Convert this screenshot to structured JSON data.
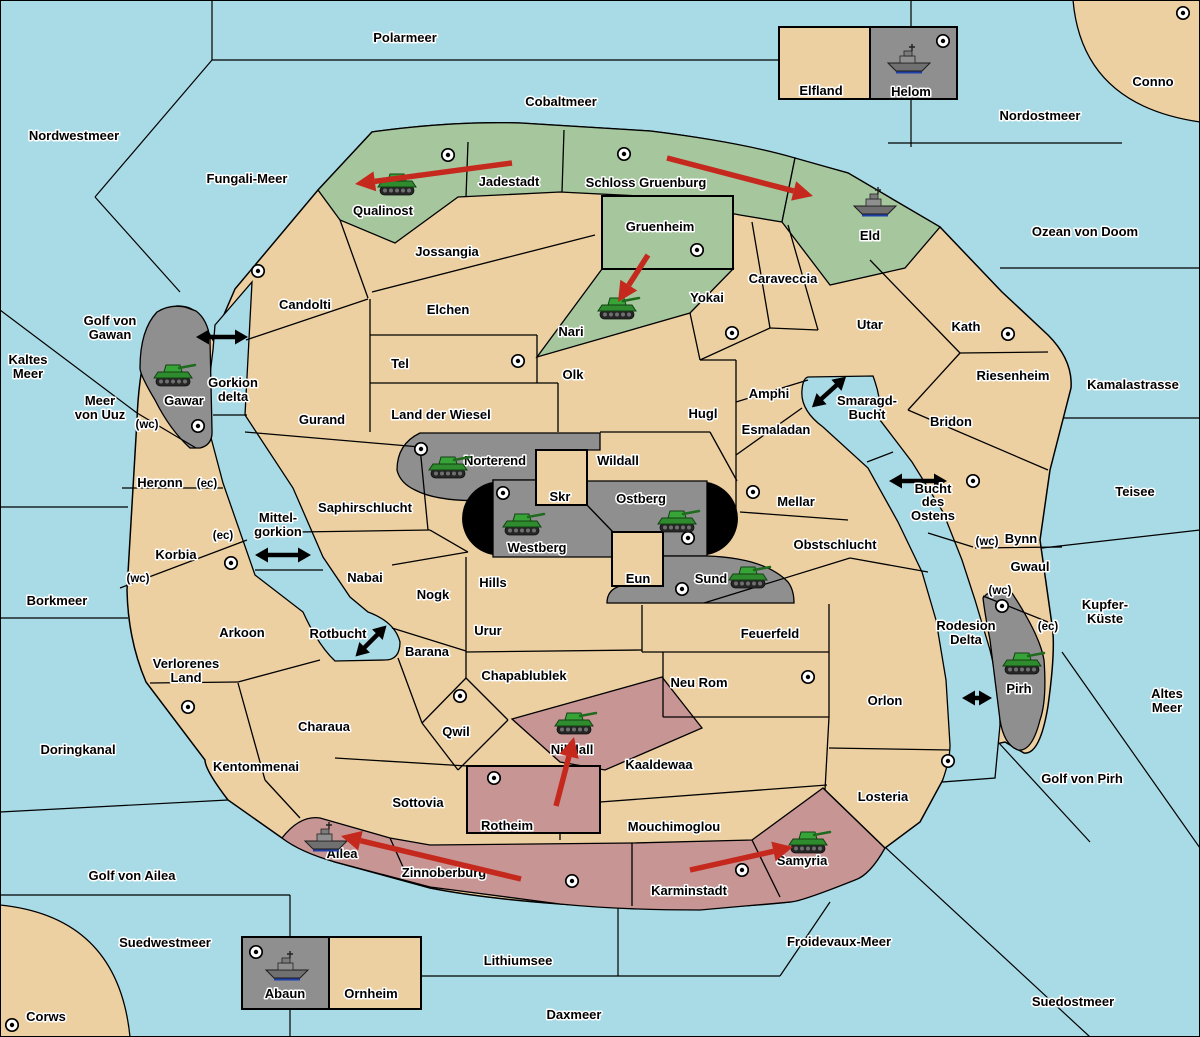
{
  "map_title": "Diplomacy variant game map",
  "colors": {
    "sea": "#a9dbe7",
    "land": "#edd0a2",
    "green_power": "#a6c79e",
    "gray_power": "#8f8f8f",
    "red_power": "#c79694",
    "move_arrow": "#c5291d",
    "border": "#000000",
    "impassable": "#000000"
  },
  "seas": [
    {
      "name": "Polarmeer",
      "x": 405,
      "y": 38
    },
    {
      "name": "Cobaltmeer",
      "x": 561,
      "y": 102
    },
    {
      "name": "Nordwestmeer",
      "x": 74,
      "y": 136
    },
    {
      "name": "Fungali-Meer",
      "x": 247,
      "y": 179
    },
    {
      "name": "Nordostmeer",
      "x": 1040,
      "y": 116
    },
    {
      "name": "Ozean von Doom",
      "x": 1085,
      "y": 232
    },
    {
      "name": "Kaltes Meer",
      "lines": [
        "Kaltes",
        "Meer"
      ],
      "x": 28,
      "y": 367
    },
    {
      "name": "Golf von Gawan",
      "lines": [
        "Golf von",
        "Gawan"
      ],
      "x": 110,
      "y": 328
    },
    {
      "name": "Meer von Uuz",
      "lines": [
        "Meer",
        "von Uuz"
      ],
      "x": 100,
      "y": 408
    },
    {
      "name": "Kamalastrasse",
      "x": 1133,
      "y": 385
    },
    {
      "name": "Teisee",
      "x": 1135,
      "y": 492
    },
    {
      "name": "Borkmeer",
      "x": 57,
      "y": 601
    },
    {
      "name": "Kupfer-Küste",
      "lines": [
        "Kupfer-",
        "Küste"
      ],
      "x": 1105,
      "y": 612
    },
    {
      "name": "Altes Meer",
      "lines": [
        "Altes",
        "Meer"
      ],
      "x": 1167,
      "y": 701
    },
    {
      "name": "Doringkanal",
      "x": 78,
      "y": 750
    },
    {
      "name": "Golf von Pirh",
      "x": 1082,
      "y": 779
    },
    {
      "name": "Golf von Ailea",
      "x": 132,
      "y": 876
    },
    {
      "name": "Suedwestmeer",
      "x": 165,
      "y": 943
    },
    {
      "name": "Lithiumsee",
      "x": 518,
      "y": 961
    },
    {
      "name": "Froidevaux-Meer",
      "x": 839,
      "y": 942
    },
    {
      "name": "Daxmeer",
      "x": 574,
      "y": 1015
    },
    {
      "name": "Suedostmeer",
      "x": 1073,
      "y": 1002
    },
    {
      "name": "Gorkion delta",
      "lines": [
        "Gorkion",
        "delta"
      ],
      "x": 233,
      "y": 390
    },
    {
      "name": "Mittel-gorkion",
      "lines": [
        "Mittel-",
        "gorkion"
      ],
      "x": 278,
      "y": 525
    },
    {
      "name": "Rotbucht",
      "x": 338,
      "y": 634
    },
    {
      "name": "Smaragd-Bucht",
      "lines": [
        "Smaragd-",
        "Bucht"
      ],
      "x": 867,
      "y": 408
    },
    {
      "name": "Bucht des Ostens",
      "lines": [
        "Bucht",
        "des",
        "Ostens"
      ],
      "x": 933,
      "y": 502
    },
    {
      "name": "Rodesion Delta",
      "lines": [
        "Rodesion",
        "Delta"
      ],
      "x": 966,
      "y": 633
    }
  ],
  "territories": [
    {
      "name": "Conno",
      "color": "tan",
      "x": 1153,
      "y": 82,
      "sc": [
        1183,
        13
      ]
    },
    {
      "name": "Corws",
      "color": "tan",
      "x": 46,
      "y": 1017,
      "sc": [
        12,
        1025
      ]
    },
    {
      "name": "Elfland",
      "color": "tan",
      "x": 821,
      "y": 91
    },
    {
      "name": "Ornheim",
      "color": "tan",
      "x": 371,
      "y": 994
    },
    {
      "name": "Candolti",
      "color": "tan",
      "x": 305,
      "y": 305,
      "sc": [
        258,
        271
      ]
    },
    {
      "name": "Jossangia",
      "color": "tan",
      "x": 447,
      "y": 252
    },
    {
      "name": "Elchen",
      "color": "tan",
      "x": 448,
      "y": 310
    },
    {
      "name": "Tel",
      "color": "tan",
      "x": 400,
      "y": 364,
      "sc": [
        518,
        361
      ]
    },
    {
      "name": "Olk",
      "color": "tan",
      "x": 573,
      "y": 375
    },
    {
      "name": "Gurand",
      "color": "tan",
      "x": 322,
      "y": 420
    },
    {
      "name": "Land der Wiesel",
      "color": "tan",
      "x": 441,
      "y": 415
    },
    {
      "name": "Hugl",
      "color": "tan",
      "x": 703,
      "y": 414
    },
    {
      "name": "Amphi",
      "color": "tan",
      "x": 769,
      "y": 394
    },
    {
      "name": "Esmaladan",
      "color": "tan",
      "x": 776,
      "y": 430
    },
    {
      "name": "Yokai",
      "color": "tan",
      "x": 707,
      "y": 298,
      "sc": [
        732,
        333
      ]
    },
    {
      "name": "Caraveccia",
      "color": "tan",
      "x": 783,
      "y": 279
    },
    {
      "name": "Utar",
      "color": "tan",
      "x": 870,
      "y": 325
    },
    {
      "name": "Kath",
      "color": "tan",
      "x": 966,
      "y": 327,
      "sc": [
        1008,
        334
      ]
    },
    {
      "name": "Riesenheim",
      "color": "tan",
      "x": 1013,
      "y": 376
    },
    {
      "name": "Bridon",
      "color": "tan",
      "x": 951,
      "y": 422
    },
    {
      "name": "Wildall",
      "color": "tan",
      "x": 618,
      "y": 461
    },
    {
      "name": "Skr",
      "color": "tan",
      "x": 560,
      "y": 497
    },
    {
      "name": "Eun",
      "color": "tan",
      "x": 638,
      "y": 579
    },
    {
      "name": "Mellar",
      "color": "tan",
      "x": 796,
      "y": 502,
      "sc": [
        753,
        492
      ]
    },
    {
      "name": "Obstschlucht",
      "color": "tan",
      "x": 835,
      "y": 545
    },
    {
      "name": "Saphirschlucht",
      "color": "tan",
      "x": 365,
      "y": 508
    },
    {
      "name": "Nabai",
      "color": "tan",
      "x": 365,
      "y": 578
    },
    {
      "name": "Nogk",
      "color": "tan",
      "x": 433,
      "y": 595
    },
    {
      "name": "Hills",
      "color": "tan",
      "x": 493,
      "y": 583
    },
    {
      "name": "Urur",
      "color": "tan",
      "x": 488,
      "y": 631
    },
    {
      "name": "Barana",
      "color": "tan",
      "x": 427,
      "y": 652
    },
    {
      "name": "Chapablublek",
      "color": "tan",
      "x": 524,
      "y": 676
    },
    {
      "name": "Qwil",
      "color": "tan",
      "x": 456,
      "y": 732,
      "sc": [
        460,
        696
      ]
    },
    {
      "name": "Charaua",
      "color": "tan",
      "x": 324,
      "y": 727
    },
    {
      "name": "Arkoon",
      "color": "tan",
      "x": 242,
      "y": 633
    },
    {
      "name": "Verlorenes Land",
      "color": "tan",
      "lines": [
        "Verlorenes",
        "Land"
      ],
      "x": 186,
      "y": 671
    },
    {
      "name": "Kentommenai",
      "color": "tan",
      "x": 256,
      "y": 767,
      "sc": [
        188,
        707
      ]
    },
    {
      "name": "Sottovia",
      "color": "tan",
      "x": 418,
      "y": 803
    },
    {
      "name": "Feuerfeld",
      "color": "tan",
      "x": 770,
      "y": 634
    },
    {
      "name": "Neu Rom",
      "color": "tan",
      "x": 699,
      "y": 683,
      "sc": [
        808,
        677
      ]
    },
    {
      "name": "Orlon",
      "color": "tan",
      "x": 885,
      "y": 701
    },
    {
      "name": "Kaaldewaa",
      "color": "tan",
      "x": 659,
      "y": 765
    },
    {
      "name": "Mouchimoglou",
      "color": "tan",
      "x": 674,
      "y": 827
    },
    {
      "name": "Losteria",
      "color": "tan",
      "x": 883,
      "y": 797,
      "sc": [
        948,
        761
      ]
    },
    {
      "name": "Heronn",
      "color": "tan",
      "x": 160,
      "y": 483
    },
    {
      "name": "Korbia",
      "color": "tan",
      "x": 176,
      "y": 555,
      "sc": [
        231,
        563
      ]
    },
    {
      "name": "Bynn",
      "color": "tan",
      "x": 1021,
      "y": 539,
      "sc": [
        973,
        481
      ]
    },
    {
      "name": "Gwaul",
      "color": "tan",
      "x": 1030,
      "y": 567
    },
    {
      "name": "Qualinost",
      "color": "green",
      "x": 383,
      "y": 211
    },
    {
      "name": "Jadestadt",
      "color": "green",
      "x": 509,
      "y": 182,
      "sc": [
        448,
        155
      ]
    },
    {
      "name": "Schloss Gruenburg",
      "color": "green",
      "x": 646,
      "y": 183,
      "sc": [
        624,
        154
      ]
    },
    {
      "name": "Gruenheim",
      "color": "green",
      "x": 660,
      "y": 227,
      "sc": [
        697,
        250
      ]
    },
    {
      "name": "Nari",
      "color": "green",
      "x": 571,
      "y": 332
    },
    {
      "name": "Eld",
      "color": "green",
      "x": 870,
      "y": 236
    },
    {
      "name": "Helom",
      "color": "gray",
      "x": 911,
      "y": 92,
      "sc": [
        943,
        41
      ]
    },
    {
      "name": "Gawar",
      "color": "gray",
      "x": 184,
      "y": 401,
      "sc": [
        198,
        426
      ]
    },
    {
      "name": "Norterend",
      "color": "gray",
      "x": 495,
      "y": 461,
      "sc": [
        421,
        449
      ]
    },
    {
      "name": "Westberg",
      "color": "gray",
      "x": 537,
      "y": 548,
      "sc": [
        503,
        493
      ]
    },
    {
      "name": "Ostberg",
      "color": "gray",
      "x": 641,
      "y": 499,
      "sc": [
        688,
        538
      ]
    },
    {
      "name": "Sund",
      "color": "gray",
      "x": 711,
      "y": 579,
      "sc": [
        682,
        589
      ]
    },
    {
      "name": "Pirh",
      "color": "gray",
      "x": 1019,
      "y": 689,
      "sc": [
        1002,
        606
      ]
    },
    {
      "name": "Abaun",
      "color": "gray",
      "x": 285,
      "y": 994,
      "sc": [
        256,
        952
      ]
    },
    {
      "name": "Nilldall",
      "color": "red",
      "x": 572,
      "y": 750
    },
    {
      "name": "Rotheim",
      "color": "red",
      "x": 507,
      "y": 826,
      "sc": [
        494,
        778
      ]
    },
    {
      "name": "Ailea",
      "color": "red",
      "x": 342,
      "y": 854
    },
    {
      "name": "Zinnoberburg",
      "color": "red",
      "x": 444,
      "y": 873,
      "sc": [
        572,
        881
      ]
    },
    {
      "name": "Karminstadt",
      "color": "red",
      "x": 689,
      "y": 891,
      "sc": [
        742,
        870
      ]
    },
    {
      "name": "Samyria",
      "color": "red",
      "x": 802,
      "y": 861
    }
  ],
  "coast_labels": [
    {
      "text": "(wc)",
      "x": 147,
      "y": 424
    },
    {
      "text": "(ec)",
      "x": 207,
      "y": 483
    },
    {
      "text": "(ec)",
      "x": 223,
      "y": 535
    },
    {
      "text": "(wc)",
      "x": 138,
      "y": 578
    },
    {
      "text": "(wc)",
      "x": 987,
      "y": 541
    },
    {
      "text": "(wc)",
      "x": 1000,
      "y": 590
    },
    {
      "text": "(ec)",
      "x": 1048,
      "y": 626
    }
  ],
  "units": [
    {
      "type": "army",
      "territory": "Qualinost",
      "x": 397,
      "y": 185
    },
    {
      "type": "army",
      "territory": "Nari",
      "x": 617,
      "y": 309
    },
    {
      "type": "army",
      "territory": "Norterend",
      "x": 448,
      "y": 468
    },
    {
      "type": "army",
      "territory": "Westberg",
      "x": 522,
      "y": 525
    },
    {
      "type": "army",
      "territory": "Ostberg",
      "x": 677,
      "y": 522
    },
    {
      "type": "army",
      "territory": "Sund",
      "x": 748,
      "y": 578
    },
    {
      "type": "army",
      "territory": "Gawar",
      "x": 173,
      "y": 376
    },
    {
      "type": "army",
      "territory": "Pirh",
      "x": 1022,
      "y": 664
    },
    {
      "type": "army",
      "territory": "Nilldall",
      "x": 574,
      "y": 724
    },
    {
      "type": "army",
      "territory": "Samyria",
      "x": 808,
      "y": 843
    },
    {
      "type": "fleet",
      "territory": "Helom",
      "x": 909,
      "y": 60
    },
    {
      "type": "fleet",
      "territory": "Eld",
      "x": 875,
      "y": 203
    },
    {
      "type": "fleet",
      "territory": "Ailea",
      "x": 326,
      "y": 838
    },
    {
      "type": "fleet",
      "territory": "Abaun",
      "x": 287,
      "y": 967
    }
  ],
  "move_arrows": [
    {
      "from": "Jadestadt",
      "to": "Qualinost",
      "x1": 512,
      "y1": 163,
      "x2": 355,
      "y2": 184
    },
    {
      "from": "Schloss Gruenburg",
      "to": "Eld",
      "x1": 667,
      "y1": 158,
      "x2": 813,
      "y2": 196
    },
    {
      "from": "Gruenheim",
      "to": "Nari",
      "x1": 648,
      "y1": 255,
      "x2": 618,
      "y2": 302
    },
    {
      "from": "Rotheim",
      "to": "Nilldall",
      "x1": 556,
      "y1": 806,
      "x2": 574,
      "y2": 737
    },
    {
      "from": "Zinnoberburg",
      "to": "Ailea",
      "x1": 521,
      "y1": 879,
      "x2": 341,
      "y2": 836
    },
    {
      "from": "Karminstadt",
      "to": "Samyria",
      "x1": 690,
      "y1": 870,
      "x2": 793,
      "y2": 847
    }
  ],
  "strait_arrows": [
    {
      "x": 222,
      "y": 337,
      "angle": 0,
      "len": 52
    },
    {
      "x": 283,
      "y": 555,
      "angle": 0,
      "len": 56
    },
    {
      "x": 371,
      "y": 641,
      "angle": -45,
      "len": 44
    },
    {
      "x": 829,
      "y": 392,
      "angle": -42,
      "len": 46
    },
    {
      "x": 918,
      "y": 481,
      "angle": 0,
      "len": 58
    },
    {
      "x": 977,
      "y": 698,
      "angle": 0,
      "len": 30
    }
  ]
}
